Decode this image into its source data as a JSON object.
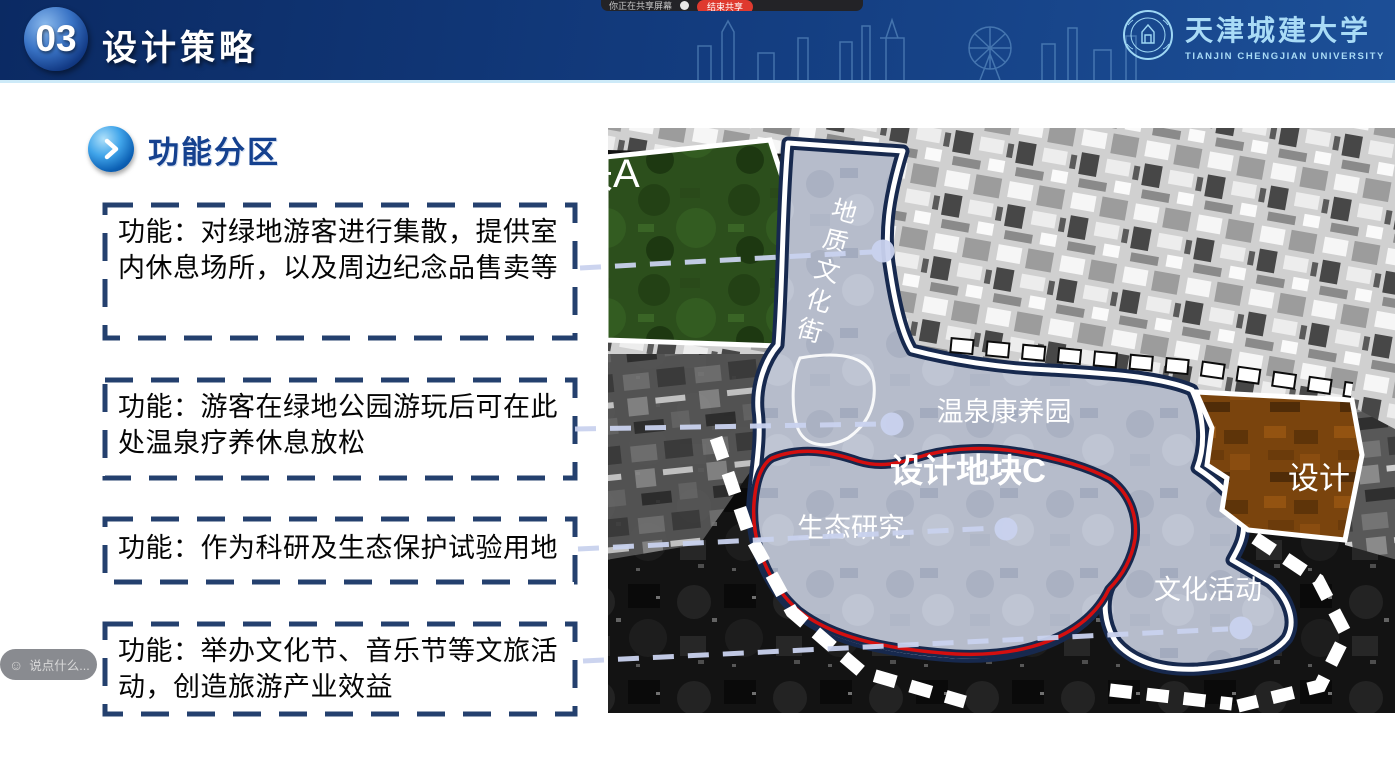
{
  "overlay": {
    "share_toolbar": {
      "label": "你正在共享屏幕",
      "stop_button": "结束共享"
    },
    "chat": {
      "placeholder": "说点什么..."
    }
  },
  "header": {
    "number": "03",
    "title": "设计策略",
    "university": {
      "cn": "天津城建大学",
      "en": "TIANJIN CHENGJIAN UNIVERSITY"
    }
  },
  "section": {
    "title": "功能分区"
  },
  "function_boxes": [
    "功能：对绿地游客进行集散，提供室内休息场所，以及周边纪念品售卖等",
    "功能：游客在绿地公园游玩后可在此处温泉疗养休息放松",
    "功能：作为科研及生态保护试验用地",
    "功能：举办文化节、音乐节等文旅活动，创造旅游产业效益"
  ],
  "map": {
    "labels": {
      "plot_a_partial": "块A",
      "geology_street": "地质文化街",
      "hot_spring_garden": "温泉康养园",
      "plot_c": "设计地块C",
      "ecology_research": "生态研究",
      "culture_activity": "文化活动",
      "plot_b_partial": "设计"
    },
    "colors": {
      "zone_fill": "#b6bccb",
      "zone_trim": "#17294e",
      "zone_outline": "#ffffff",
      "red_boundary": "#d40f0f",
      "green_plot": "#2c4f1c",
      "orange_plot": "#7a440d",
      "connector": "#c9d2ee",
      "box_border": "#24406e"
    }
  }
}
